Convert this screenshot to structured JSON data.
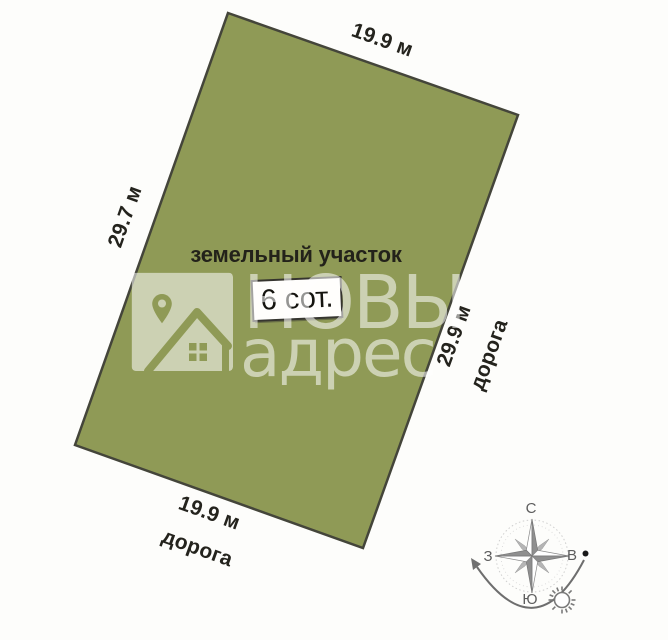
{
  "plot": {
    "label": "земельный участок",
    "area_badge": "6 сот.",
    "top_length": "19.9 м",
    "left_length": "29.7 м",
    "right_length": "29.9 м",
    "bottom_length": "19.9 м",
    "right_road": "дорога",
    "bottom_road": "дорога",
    "fill_color": "#8f9a56",
    "border_color": "#44453a"
  },
  "watermark": {
    "brand_top": "НОВЫ",
    "brand_bottom": "адрес"
  },
  "compass": {
    "north": "С",
    "south": "Ю",
    "west": "З",
    "east": "В"
  }
}
